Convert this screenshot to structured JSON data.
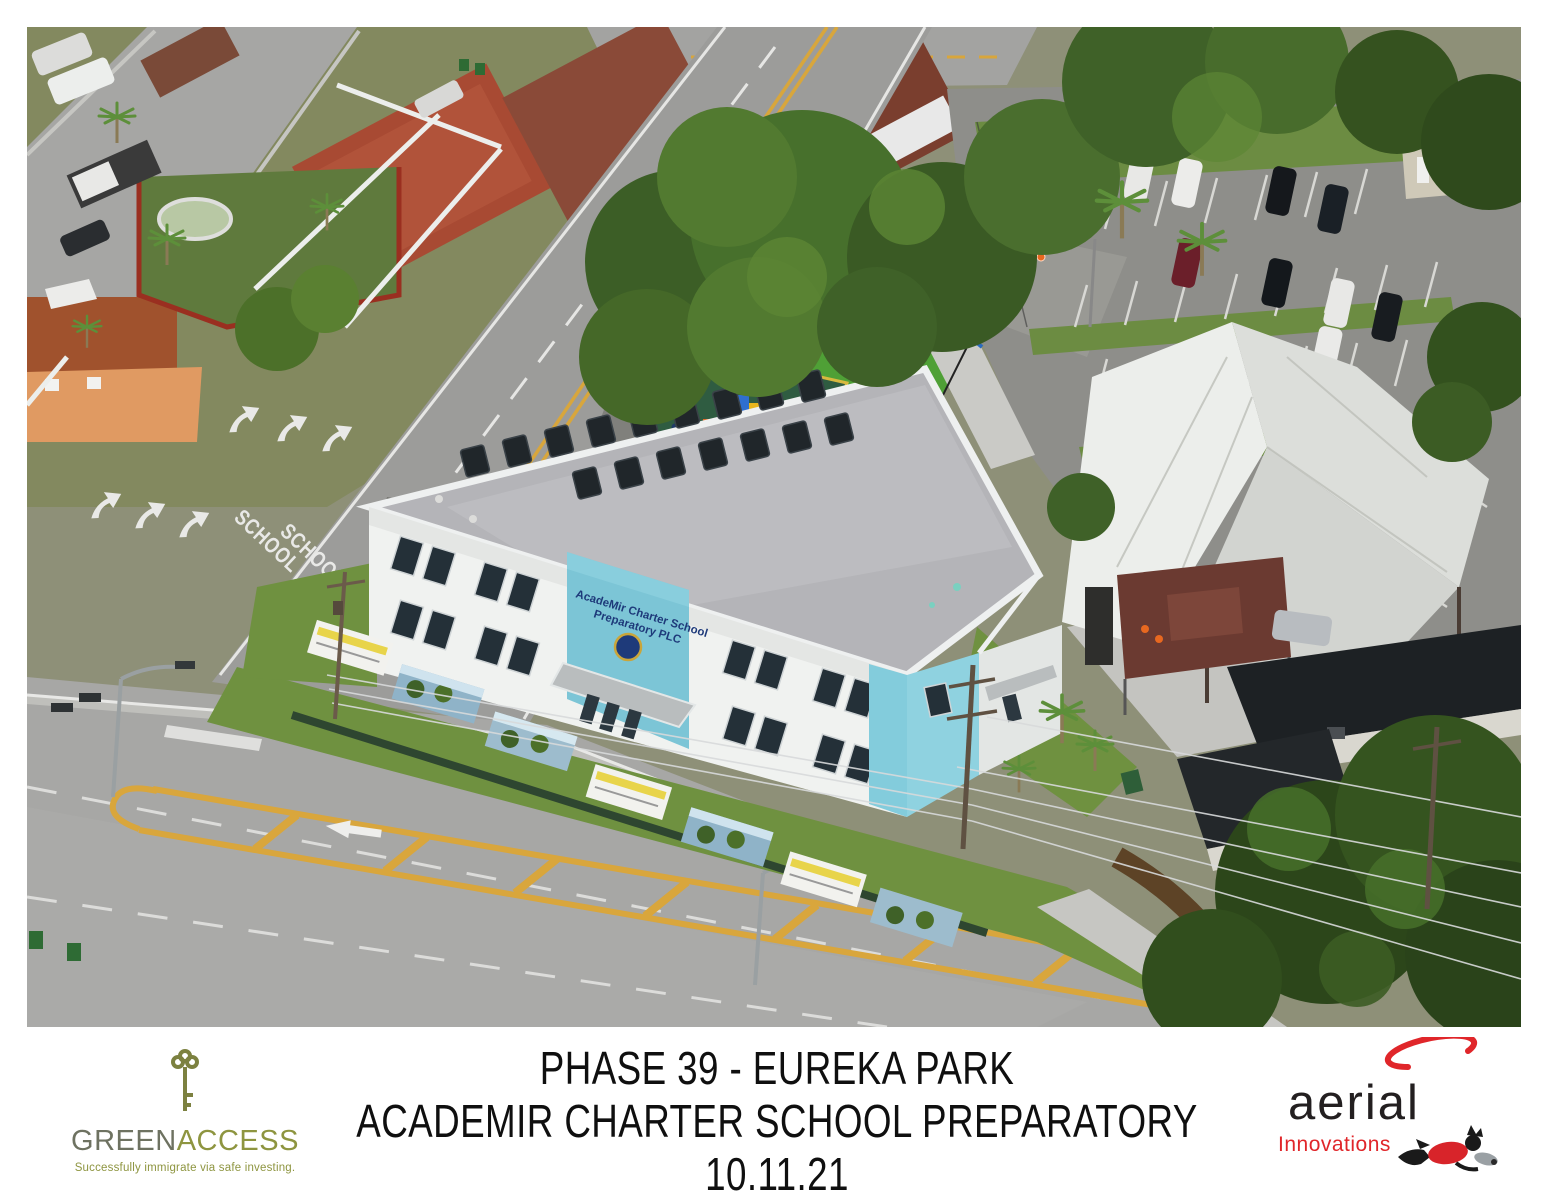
{
  "photo": {
    "description": "Aerial photograph of a new charter school campus beside a residential neighborhood, parking lot and main road",
    "building_sign": {
      "line1": "AcadeMir Charter School",
      "line2": "Preparatory PLC",
      "panel_color": "#7cc5d6",
      "text_color": "#1e3a7a"
    },
    "pavement_marking": "SCHOOL"
  },
  "footer": {
    "caption": {
      "line1": "PHASE 39 - EUREKA PARK",
      "line2": "ACADEMIR CHARTER SCHOOL PREPARATORY",
      "line3": "10.11.21",
      "color": "#0f0f0f"
    },
    "greenaccess": {
      "brand_part1": "GREEN",
      "brand_part2": "ACCESS",
      "tagline": "Successfully immigrate via safe investing.",
      "color_part1": "#6e7261",
      "color_part2": "#8e9540",
      "key_color": "#7c8140"
    },
    "aerial": {
      "word1": "aerial",
      "word2": "Innovations",
      "word1_color": "#231f20",
      "word2_color": "#e0262a",
      "swoosh_color": "#e0262a"
    }
  }
}
